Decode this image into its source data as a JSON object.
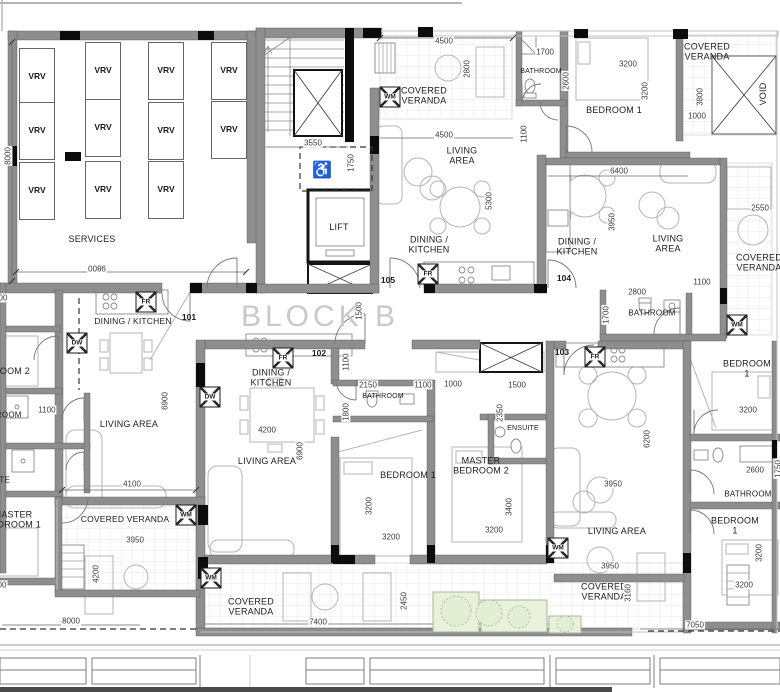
{
  "drawing": {
    "block_label": "BLOCK B",
    "wheelchair_icon": "♿",
    "lift_label": "LIFT"
  },
  "colors": {
    "wall": "#8e8e8e",
    "column": "#0c0c0c",
    "dim_text": "#3a3a3a",
    "room_text": "#1c1c1c",
    "block_text": "#c9c9c9",
    "furniture": "#b5b5b5",
    "planter_fill": "#e9f1dc",
    "planter_stroke": "#a8b796"
  },
  "rooms": [
    {
      "t": "SERVICES",
      "x": 92,
      "y": 239
    },
    {
      "t": "COVERED\nVERANDA",
      "x": 424,
      "y": 96
    },
    {
      "t": "LIVING\nAREA",
      "x": 462,
      "y": 156
    },
    {
      "t": "DINING /\nKITCHEN",
      "x": 429,
      "y": 245
    },
    {
      "t": "BATHROOM",
      "x": 541,
      "y": 72,
      "s": 7
    },
    {
      "t": "BEDROOM 1",
      "x": 614,
      "y": 110
    },
    {
      "t": "COVERED\nVERANDA",
      "x": 707,
      "y": 52
    },
    {
      "t": "VOID",
      "x": 763,
      "y": 94,
      "r": -90
    },
    {
      "t": "DINING /\nKITCHEN",
      "x": 577,
      "y": 247
    },
    {
      "t": "LIVING\nAREA",
      "x": 668,
      "y": 244
    },
    {
      "t": "COVERED\nVERANDA",
      "x": 759,
      "y": 263
    },
    {
      "t": "BATHROOM",
      "x": 652,
      "y": 313,
      "s": 8
    },
    {
      "t": "DINING / KITCHEN",
      "x": 133,
      "y": 322,
      "s": 8.5
    },
    {
      "t": "LIVING AREA",
      "x": 129,
      "y": 424
    },
    {
      "t": "BEDROOM 2",
      "x": 2,
      "y": 371
    },
    {
      "t": "BATHROOM",
      "x": -2,
      "y": 415,
      "s": 8
    },
    {
      "t": "ENSUITE",
      "x": -8,
      "y": 480,
      "s": 8
    },
    {
      "t": "MASTER\nBEDROOM 1",
      "x": 13,
      "y": 520
    },
    {
      "t": "DINING /\nKITCHEN",
      "x": 271,
      "y": 378
    },
    {
      "t": "LIVING AREA",
      "x": 267,
      "y": 461
    },
    {
      "t": "BATHROOM",
      "x": 383,
      "y": 397,
      "s": 7
    },
    {
      "t": "BEDROOM 1",
      "x": 408,
      "y": 475
    },
    {
      "t": "MASTER\nBEDROOM 2",
      "x": 481,
      "y": 466
    },
    {
      "t": "ENSUITE",
      "x": 523,
      "y": 429,
      "s": 7
    },
    {
      "t": "LIVING AREA",
      "x": 617,
      "y": 531
    },
    {
      "t": "BEDROOM 1",
      "x": 747,
      "y": 369
    },
    {
      "t": "BATHROOM",
      "x": 748,
      "y": 494,
      "s": 8
    },
    {
      "t": "BEDROOM 1",
      "x": 735,
      "y": 526
    },
    {
      "t": "COVERED VERANDA",
      "x": 125,
      "y": 520,
      "s": 8.5
    },
    {
      "t": "COVERED\nVERANDA",
      "x": 251,
      "y": 607
    },
    {
      "t": "COVERED\nVERANDA",
      "x": 604,
      "y": 592
    },
    {
      "t": "LIFT",
      "x": 339,
      "y": 227
    }
  ],
  "vrv_units": [
    {
      "t": "VRV",
      "x": 37,
      "y": 77
    },
    {
      "t": "VRV",
      "x": 37,
      "y": 131
    },
    {
      "t": "VRV",
      "x": 37,
      "y": 191
    },
    {
      "t": "VRV",
      "x": 103,
      "y": 71
    },
    {
      "t": "VRV",
      "x": 103,
      "y": 128
    },
    {
      "t": "VRV",
      "x": 103,
      "y": 190
    },
    {
      "t": "VRV",
      "x": 166,
      "y": 71
    },
    {
      "t": "VRV",
      "x": 166,
      "y": 131
    },
    {
      "t": "VRV",
      "x": 166,
      "y": 190
    },
    {
      "t": "VRV",
      "x": 229,
      "y": 71
    },
    {
      "t": "VRV",
      "x": 229,
      "y": 130
    }
  ],
  "unit_numbers": [
    {
      "t": "101",
      "x": 189,
      "y": 318
    },
    {
      "t": "102",
      "x": 319,
      "y": 354
    },
    {
      "t": "103",
      "x": 562,
      "y": 353
    },
    {
      "t": "104",
      "x": 564,
      "y": 279
    },
    {
      "t": "105",
      "x": 388,
      "y": 281
    }
  ],
  "appliances": [
    {
      "t": "FR",
      "x": 428,
      "y": 274
    },
    {
      "t": "FR",
      "x": 146,
      "y": 302
    },
    {
      "t": "FR",
      "x": 283,
      "y": 358
    },
    {
      "t": "FR",
      "x": 595,
      "y": 357
    },
    {
      "t": "DW",
      "x": 77,
      "y": 343
    },
    {
      "t": "DW",
      "x": 210,
      "y": 397
    },
    {
      "t": "WM",
      "x": 390,
      "y": 97
    },
    {
      "t": "WM",
      "x": 737,
      "y": 325
    },
    {
      "t": "WM",
      "x": 186,
      "y": 515
    },
    {
      "t": "WM",
      "x": 211,
      "y": 578
    },
    {
      "t": "WM",
      "x": 558,
      "y": 548
    }
  ],
  "dims_h": [
    {
      "t": "4500",
      "x": 444,
      "y": 41
    },
    {
      "t": "1700",
      "x": 545,
      "y": 52
    },
    {
      "t": "3200",
      "x": 628,
      "y": 64
    },
    {
      "t": "1000",
      "x": 697,
      "y": 116
    },
    {
      "t": "3550",
      "x": 313,
      "y": 143
    },
    {
      "t": "4500",
      "x": 444,
      "y": 135
    },
    {
      "t": "6400",
      "x": 619,
      "y": 171
    },
    {
      "t": "2550",
      "x": 760,
      "y": 208
    },
    {
      "t": "2800",
      "x": 637,
      "y": 292
    },
    {
      "t": "1100",
      "x": 702,
      "y": 282
    },
    {
      "t": "2150",
      "x": 368,
      "y": 385
    },
    {
      "t": "1100",
      "x": 423,
      "y": 385
    },
    {
      "t": "1000",
      "x": 453,
      "y": 384
    },
    {
      "t": "1500",
      "x": 517,
      "y": 385
    },
    {
      "t": "4200",
      "x": 267,
      "y": 430
    },
    {
      "t": "4100",
      "x": 132,
      "y": 484
    },
    {
      "t": "1100",
      "x": 47,
      "y": 410
    },
    {
      "t": "3200",
      "x": 391,
      "y": 537
    },
    {
      "t": "3200",
      "x": 494,
      "y": 530
    },
    {
      "t": "3950",
      "x": 135,
      "y": 540
    },
    {
      "t": "3950",
      "x": 613,
      "y": 484
    },
    {
      "t": "2600",
      "x": 755,
      "y": 470
    },
    {
      "t": "3200",
      "x": 748,
      "y": 410
    },
    {
      "t": "3200",
      "x": 744,
      "y": 585
    },
    {
      "t": "8000",
      "x": 71,
      "y": 621
    },
    {
      "t": "7400",
      "x": 318,
      "y": 622
    },
    {
      "t": "3950",
      "x": 610,
      "y": 566
    },
    {
      "t": "7050",
      "x": 695,
      "y": 625
    },
    {
      "t": "00",
      "x": 3,
      "y": 298
    },
    {
      "t": "00",
      "x": 2,
      "y": 585
    }
  ],
  "dims_v": [
    {
      "t": "8000",
      "x": 8,
      "y": 156
    },
    {
      "t": "2800",
      "x": 467,
      "y": 69
    },
    {
      "t": "2600",
      "x": 566,
      "y": 81
    },
    {
      "t": "3200",
      "x": 645,
      "y": 91
    },
    {
      "t": "3800",
      "x": 700,
      "y": 97
    },
    {
      "t": "5300",
      "x": 489,
      "y": 201
    },
    {
      "t": "1750",
      "x": 351,
      "y": 163
    },
    {
      "t": "1100",
      "x": 524,
      "y": 134
    },
    {
      "t": "3950",
      "x": 612,
      "y": 222
    },
    {
      "t": "1500",
      "x": 359,
      "y": 311
    },
    {
      "t": "1700",
      "x": 606,
      "y": 315
    },
    {
      "t": "1100",
      "x": 346,
      "y": 362
    },
    {
      "t": "1800",
      "x": 346,
      "y": 412
    },
    {
      "t": "6900",
      "x": 300,
      "y": 451
    },
    {
      "t": "6900",
      "x": 165,
      "y": 401
    },
    {
      "t": "3200",
      "x": 369,
      "y": 506
    },
    {
      "t": "2350",
      "x": 500,
      "y": 413
    },
    {
      "t": "3400",
      "x": 509,
      "y": 507
    },
    {
      "t": "6200",
      "x": 647,
      "y": 439
    },
    {
      "t": "3200",
      "x": 759,
      "y": 553
    },
    {
      "t": "1750",
      "x": 778,
      "y": 469
    },
    {
      "t": "4200",
      "x": 96,
      "y": 574
    },
    {
      "t": "2450",
      "x": 404,
      "y": 601
    },
    {
      "t": "3160",
      "x": 628,
      "y": 593
    }
  ],
  "dims_flipped": [
    {
      "t": "9800",
      "x": 97,
      "y": 268
    }
  ]
}
